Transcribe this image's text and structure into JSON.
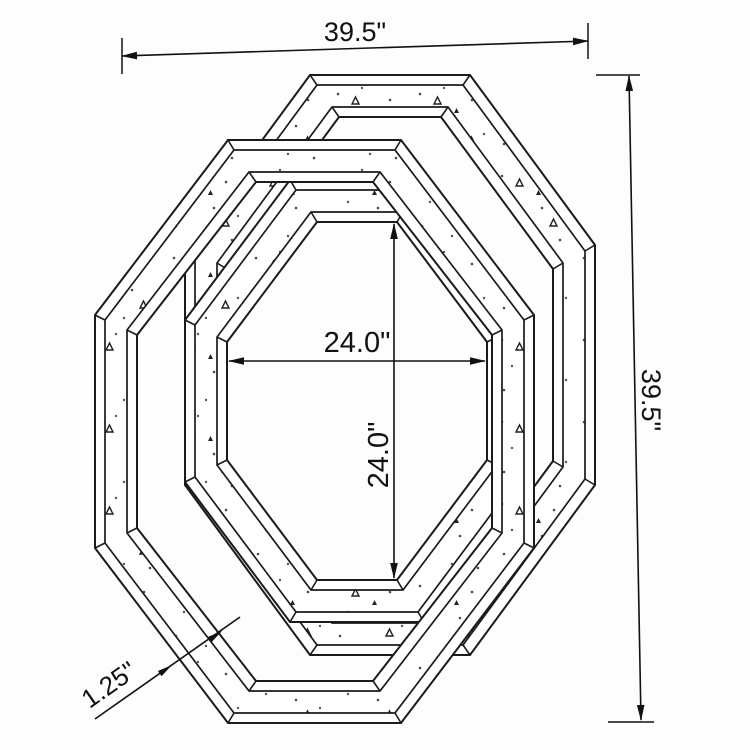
{
  "drawing": {
    "dimensions": {
      "overall_width": "39.5\"",
      "overall_height": "39.5\"",
      "inner_width": "24.0\"",
      "inner_height": "24.0\"",
      "frame_thickness": "1.25\""
    }
  }
}
